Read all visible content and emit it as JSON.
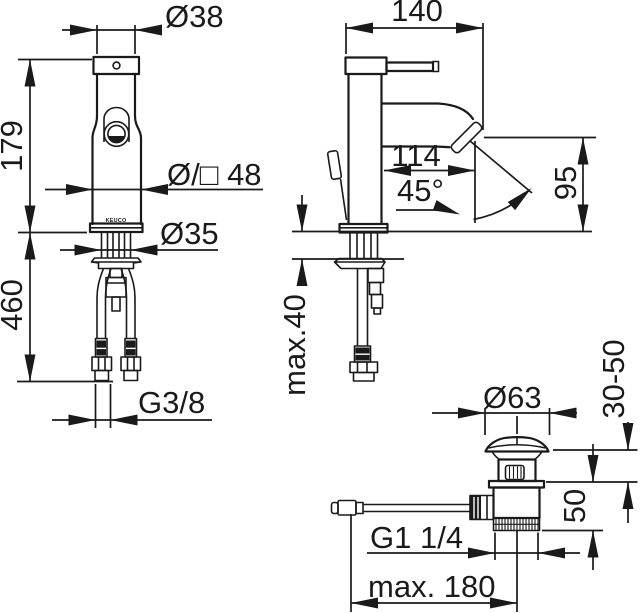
{
  "drawing": {
    "title": "faucet-technical-drawing",
    "background": "#ffffff",
    "ink": "#1a1a1a",
    "brand_label": "KEUCO",
    "front_view": {
      "top_diameter": "Ø38",
      "height": "179",
      "body_size": "Ø/□ 48",
      "shank_diameter": "Ø35",
      "hose_length": "460",
      "supply_thread": "G3/8"
    },
    "side_view": {
      "depth": "140",
      "spout_reach": "114",
      "spout_angle": "45°",
      "outlet_height": "95",
      "deck_thickness_max": "max.40"
    },
    "drain_view": {
      "plug_diameter": "Ø63",
      "clamp_range": "30-50",
      "thread_length": "50",
      "waste_thread": "G1 1/4",
      "rod_reach_max": "max. 180"
    }
  }
}
